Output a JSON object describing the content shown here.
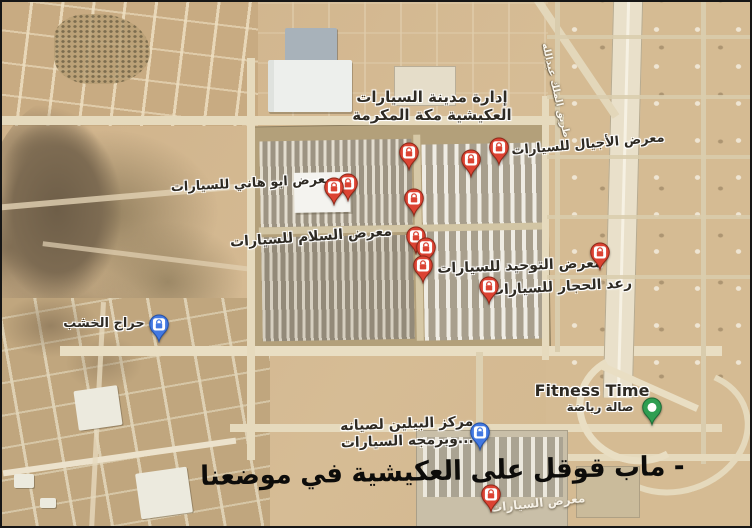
{
  "view": {
    "type": "google-maps-satellite-screenshot",
    "area": "العكيشية - مكة المكرمة"
  },
  "colors": {
    "sand": "#d1b58c",
    "rock": "#8a7659",
    "road_light": "#e6dabd",
    "pin_red": "#dc4333",
    "pin_blue": "#4379e2",
    "pin_green": "#2f9e52",
    "label_text": "#2e2a23",
    "watermark_text": "#0d0c0a"
  },
  "pin_styles": {
    "red": {
      "body": "#dc4333",
      "edge": "#8f2818"
    },
    "blue": {
      "body": "#4379e2",
      "edge": "#2350a8"
    },
    "green": {
      "body": "#2f9e52",
      "edge": "#1c6b36"
    }
  },
  "pins": [
    {
      "name": "pin-car-city-admin",
      "style": "red",
      "icon": "bag",
      "x": 407,
      "y": 168
    },
    {
      "name": "pin-showroom-2",
      "style": "red",
      "icon": "bag",
      "x": 469,
      "y": 175
    },
    {
      "name": "pin-ajyal-showroom",
      "style": "red",
      "icon": "bag",
      "x": 497,
      "y": 163
    },
    {
      "name": "pin-showroom-4",
      "style": "red",
      "icon": "bag",
      "x": 412,
      "y": 214
    },
    {
      "name": "pin-abu-hani-1",
      "style": "red",
      "icon": "bag",
      "x": 332,
      "y": 203
    },
    {
      "name": "pin-abu-hani-2",
      "style": "red",
      "icon": "bag",
      "x": 346,
      "y": 199
    },
    {
      "name": "pin-salam-showroom",
      "style": "red",
      "icon": "bag",
      "x": 414,
      "y": 252
    },
    {
      "name": "pin-cluster-mid",
      "style": "red",
      "icon": "bag",
      "x": 424,
      "y": 263
    },
    {
      "name": "pin-cluster-low",
      "style": "red",
      "icon": "bag",
      "x": 421,
      "y": 281
    },
    {
      "name": "pin-tawhid-showroom",
      "style": "red",
      "icon": "bag",
      "x": 598,
      "y": 268
    },
    {
      "name": "pin-raad-hajjar",
      "style": "red",
      "icon": "bag",
      "x": 487,
      "y": 302
    },
    {
      "name": "pin-kharaj-khashab",
      "style": "blue",
      "icon": "bag",
      "x": 157,
      "y": 340
    },
    {
      "name": "pin-bailin-center",
      "style": "blue",
      "icon": "bag",
      "x": 478,
      "y": 448
    },
    {
      "name": "pin-fitness-time",
      "style": "green",
      "icon": "circle",
      "x": 650,
      "y": 423
    },
    {
      "name": "pin-hidden-showroom",
      "style": "red",
      "icon": "bag",
      "x": 489,
      "y": 510
    }
  ],
  "labels": [
    {
      "name": "label-car-city-admin",
      "lines": [
        "إدارة مدينة السيارات",
        "العكيشية مكة المكرمة"
      ],
      "x": 430,
      "y": 87,
      "size": 15,
      "rotate": 0
    },
    {
      "name": "label-ajyal",
      "lines": [
        "معرض الأجيال للسيارات"
      ],
      "x": 586,
      "y": 135,
      "size": 13,
      "rotate": -5
    },
    {
      "name": "label-abu-hani",
      "lines": [
        "معرض ابو هاني للسيارات"
      ],
      "x": 250,
      "y": 174,
      "size": 13,
      "rotate": -3
    },
    {
      "name": "label-salam",
      "lines": [
        "معرض السلام للسيارات"
      ],
      "x": 309,
      "y": 227,
      "size": 14,
      "rotate": -4
    },
    {
      "name": "label-tawhid",
      "lines": [
        "معرض التوحيد للسيارات"
      ],
      "x": 518,
      "y": 256,
      "size": 14,
      "rotate": -2
    },
    {
      "name": "label-raad-hajjar",
      "lines": [
        "رعد الحجار للسيارات"
      ],
      "x": 559,
      "y": 277,
      "size": 14,
      "rotate": -3
    },
    {
      "name": "label-kharaj-khashab",
      "lines": [
        "حراج الخشب"
      ],
      "x": 102,
      "y": 314,
      "size": 13,
      "rotate": 0
    },
    {
      "name": "label-fitness-time",
      "lines": [
        "Fitness Time"
      ],
      "x": 590,
      "y": 380,
      "size": 16,
      "rotate": 0
    },
    {
      "name": "label-fitness-time-ar",
      "lines": [
        "صالة رياضة"
      ],
      "x": 598,
      "y": 398,
      "size": 12,
      "rotate": 0
    },
    {
      "name": "label-bailin",
      "lines": [
        "مركز البيلين لصيانه",
        "وبرمجه السيارات..."
      ],
      "x": 405,
      "y": 414,
      "size": 14,
      "rotate": -2
    }
  ],
  "road_label": {
    "text": "طريق الملك عبدالله"
  },
  "hidden_label": {
    "text": "معرض السيارات"
  },
  "watermark": {
    "full_text": "موضعنا في العكيشية على قوقل ماب",
    "words": [
      "موضعنا",
      "في",
      "العكيشية",
      "على",
      "قوقل",
      "ماب",
      "-"
    ]
  }
}
